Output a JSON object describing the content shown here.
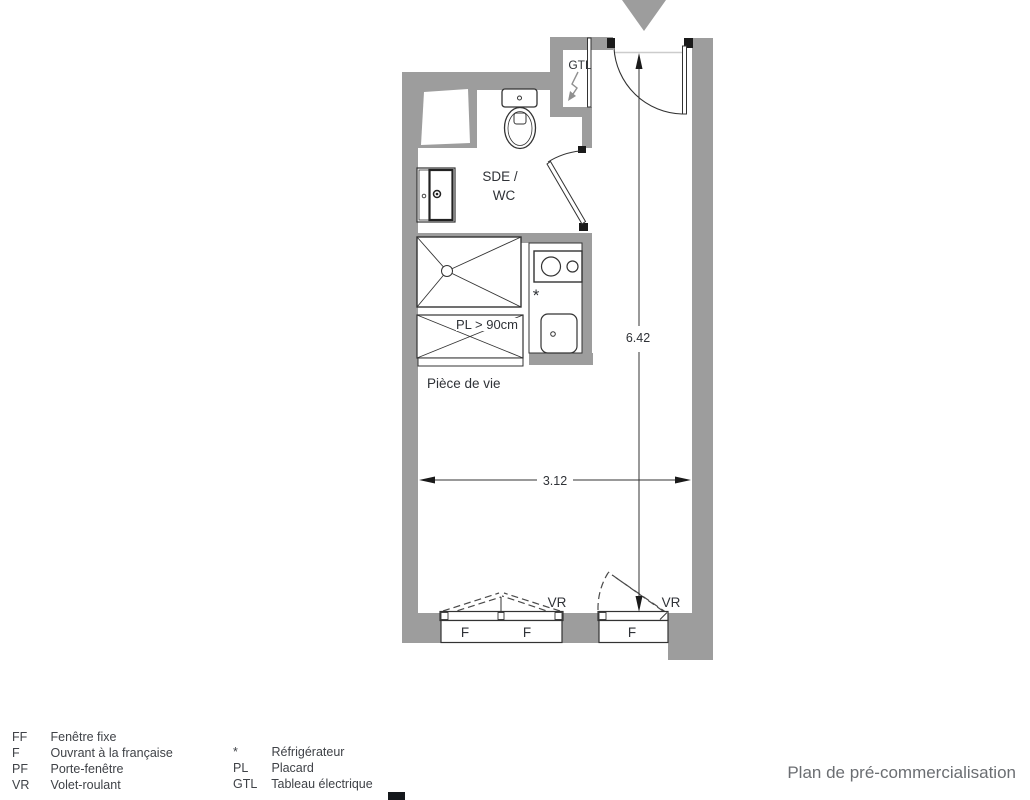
{
  "title": "Plan de pré-commercialisation",
  "colors": {
    "wall": "#9d9d9d",
    "line": "#333333",
    "text": "#2f3237",
    "title_text": "#6b6e72",
    "dash": "#4a4a4a"
  },
  "plan": {
    "labels": {
      "gtl": "GTL",
      "bathroom_line1": "SDE /",
      "bathroom_line2": "WC",
      "placard": "PL > 90cm",
      "living_room": "Pièce de vie",
      "fridge_star": "*",
      "dim_vertical": "6.42",
      "dim_horizontal": "3.12",
      "window_left_f1": "F",
      "window_left_f2": "F",
      "window_left_vr": "VR",
      "window_right_f": "F",
      "window_right_vr": "VR"
    }
  },
  "legend": {
    "left": [
      {
        "key": "FF",
        "label": "Fenêtre fixe"
      },
      {
        "key": "F",
        "label": "Ouvrant à la française"
      },
      {
        "key": "PF",
        "label": "Porte-fenêtre"
      },
      {
        "key": "VR",
        "label": "Volet-roulant"
      }
    ],
    "right": [
      {
        "key": "*",
        "label": "Réfrigérateur"
      },
      {
        "key": "PL",
        "label": "Placard"
      },
      {
        "key": "GTL",
        "label": "Tableau électrique"
      }
    ]
  }
}
